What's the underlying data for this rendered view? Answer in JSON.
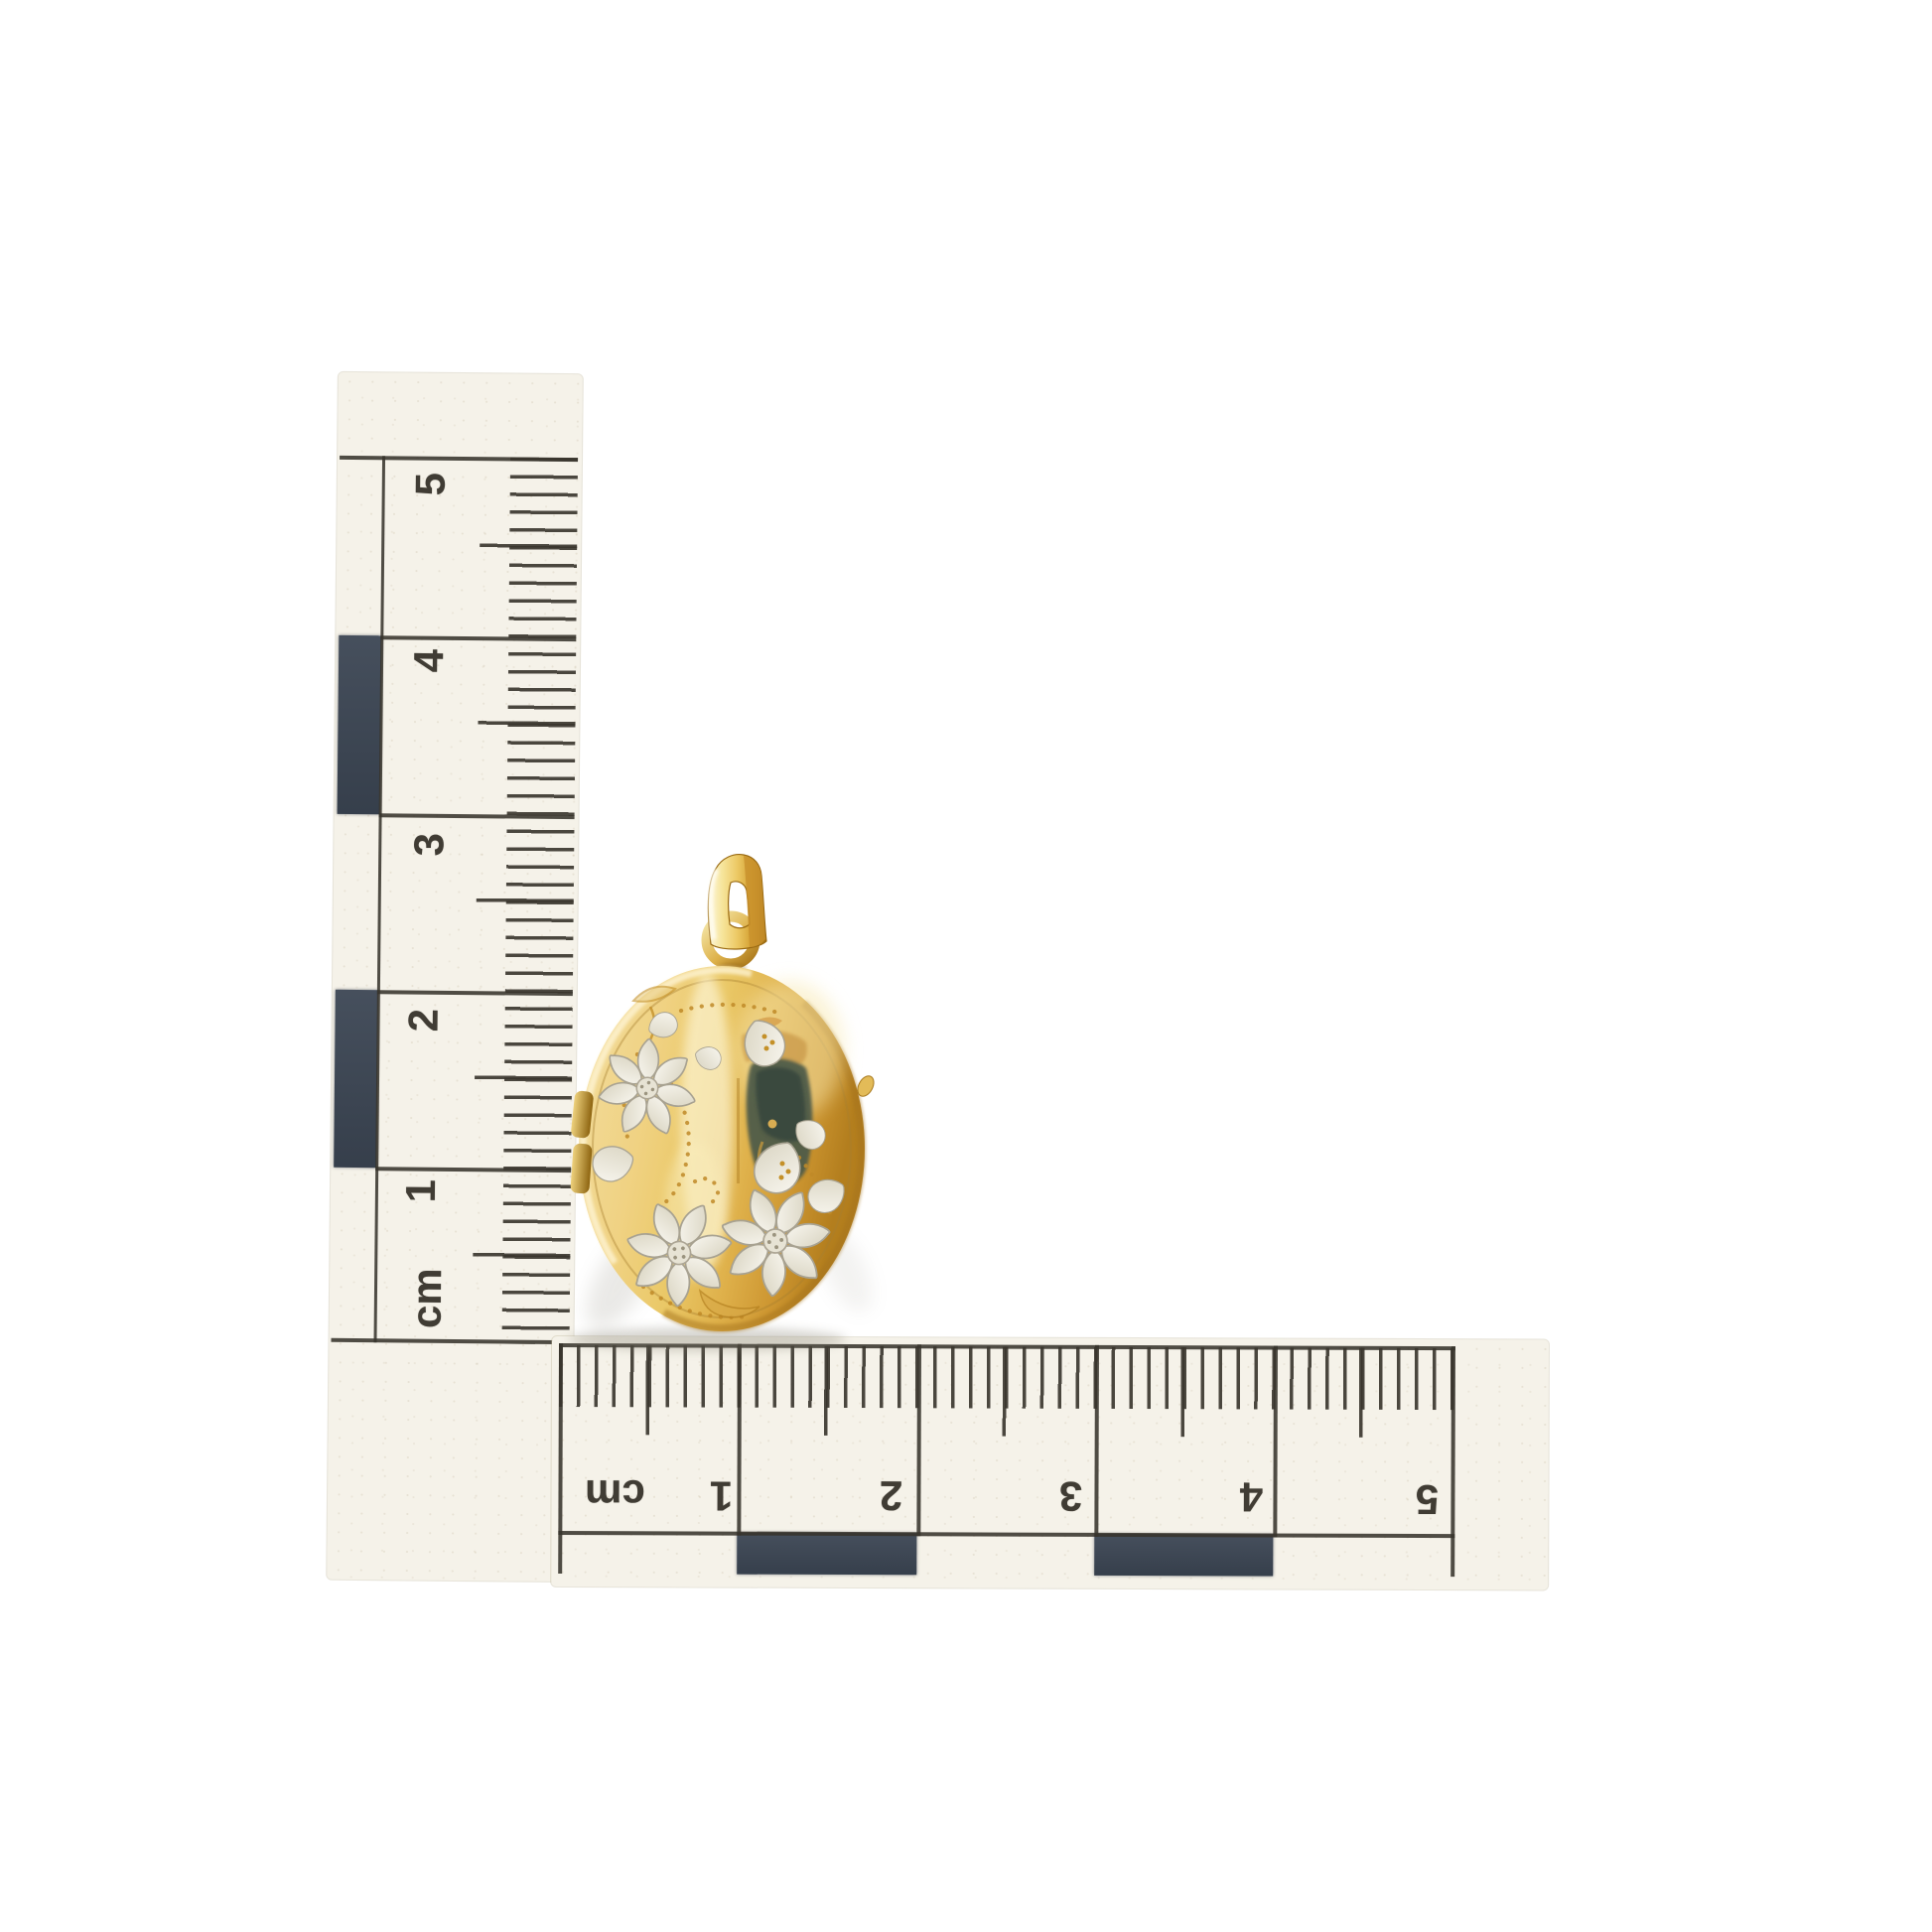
{
  "photo": {
    "subject": "Yellow gold oval locket pendant with engraved silver flowers photographed beside two centimetre scale rulers",
    "background_color": "#ffffff",
    "vertical_ruler": {
      "unit_label": "cm",
      "numbers": [
        "5",
        "4",
        "3",
        "2",
        "1"
      ],
      "tick_interval_mm": 1,
      "ink_color": "#3e3a32",
      "checker_color": "#3c4654",
      "paper_color": "#f5f2e9"
    },
    "horizontal_ruler": {
      "unit_label": "cm",
      "numbers": [
        "1",
        "2",
        "3",
        "4",
        "5"
      ],
      "tick_interval_mm": 1,
      "ink_color": "#3e3a32",
      "checker_color": "#3c4654",
      "paper_color": "#f5f2e9"
    },
    "corner_block_color": "#3e4856",
    "locket": {
      "gold_color": "#eac867",
      "gold_deep_color": "#b37e1e",
      "silver_engraving_color": "#efece0",
      "approx_width_cm": 1.6,
      "approx_height_cm": 2.1
    }
  }
}
